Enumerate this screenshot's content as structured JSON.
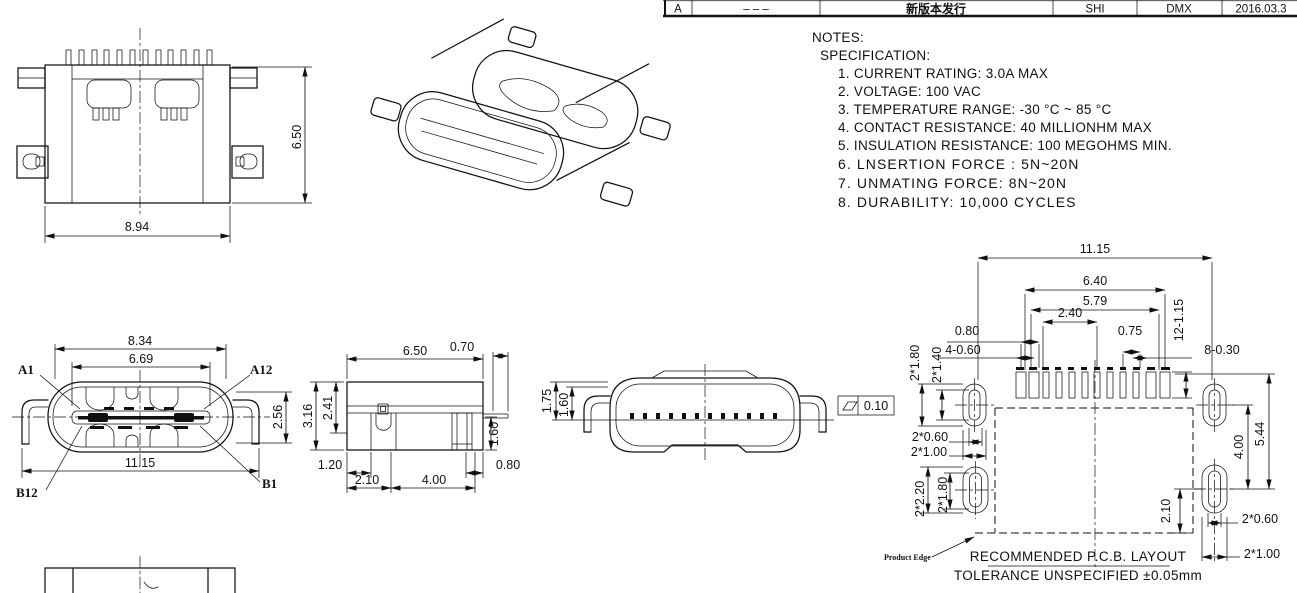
{
  "title_block": {
    "rev": "A",
    "ecn": "– – –",
    "desc": "新版本发行",
    "drawn": "SHI",
    "checked": "DMX",
    "date": "2016.03.3"
  },
  "notes": {
    "heading": "NOTES:",
    "subheading": "SPECIFICATION:",
    "items": [
      "1. CURRENT RATING: 3.0A MAX",
      "2. VOLTAGE: 100 VAC",
      "3. TEMPERATURE RANGE: -30 °C ~ 85 °C",
      "4. CONTACT RESISTANCE: 40 MILLIONHM MAX",
      "5. INSULATION RESISTANCE: 100 MEGOHMS MIN.",
      "6. LNSERTION FORCE : 5N~20N",
      "7. UNMATING FORCE: 8N~20N",
      "8. DURABILITY:   10,000 CYCLES"
    ]
  },
  "top_view": {
    "height": "6.50",
    "width": "8.94"
  },
  "front_view": {
    "shell_width": "8.34",
    "tongue_width": "6.69",
    "height": "2.56",
    "overall_width": "11.15",
    "pin_a1": "A1",
    "pin_a12": "A12",
    "pin_b1": "B1",
    "pin_b12": "B12"
  },
  "side_view": {
    "lead": "0.70",
    "width": "6.50",
    "height": "3.16",
    "shell_height": "2.41",
    "leg_height": "1.60",
    "d1": "1.20",
    "d2": "2.10",
    "d3": "4.00",
    "d4": "0.80"
  },
  "end_view": {
    "h1": "1.75",
    "h2": "1.60",
    "flatness": "0.10"
  },
  "pcb": {
    "overall": "11.15",
    "pads_outer": "6.40",
    "pads_span": "5.79",
    "center_span": "2.40",
    "pitch1": "0.80",
    "pitch2": "0.75",
    "pad_size": "12-1.15",
    "hole1": "4-0.60",
    "hole2": "8-0.30",
    "slot_a1": "2*1.80",
    "slot_a2": "2*1.40",
    "slot_a3": "2*0.60",
    "slot_a4": "2*1.00",
    "slot_b1": "2*2.20",
    "slot_b2": "2*1.80",
    "gap": "4.00",
    "span": "5.44",
    "edge": "2.10",
    "slot_c1": "2*0.60",
    "slot_c2": "2*1.00",
    "product_edge": "Product Edge",
    "title": "RECOMMENDED   P.C.B. LAYOUT",
    "tolerance": "TOLERANCE UNSPECIFIED ±0.05mm"
  },
  "colors": {
    "line": "#111111",
    "background": "#ffffff"
  }
}
